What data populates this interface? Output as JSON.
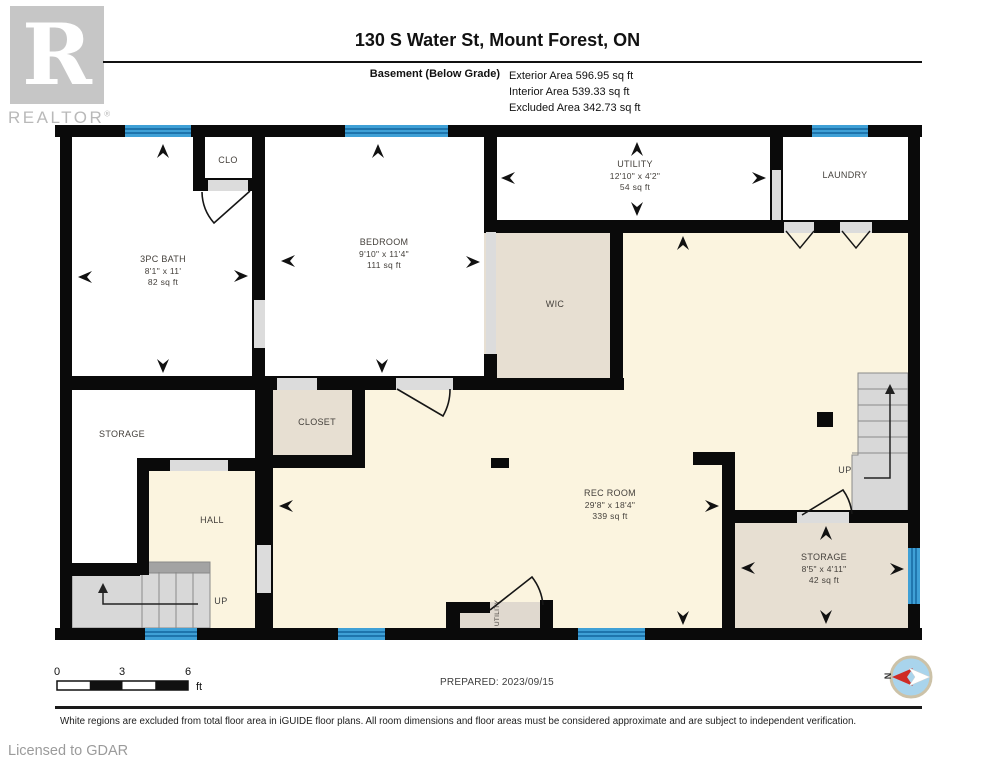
{
  "header": {
    "title": "130 S Water St, Mount Forest, ON",
    "floor_label": "Basement (Below Grade)",
    "areas": [
      "Exterior Area 596.95 sq ft",
      "Interior Area 539.33 sq ft",
      "Excluded Area 342.73 sq ft"
    ],
    "logo_letter": "R",
    "logo_text": "REALTOR",
    "registered_mark": "®"
  },
  "rooms": [
    {
      "name": "3PC BATH",
      "dims": "8'1\" x 11'",
      "area": "82 sq ft"
    },
    {
      "name": "CLO"
    },
    {
      "name": "BEDROOM",
      "dims": "9'10\" x 11'4\"",
      "area": "111 sq ft"
    },
    {
      "name": "UTILITY",
      "dims": "12'10\" x 4'2\"",
      "area": "54 sq ft"
    },
    {
      "name": "LAUNDRY"
    },
    {
      "name": "WIC"
    },
    {
      "name": "STORAGE"
    },
    {
      "name": "CLOSET"
    },
    {
      "name": "HALL"
    },
    {
      "name": "REC ROOM",
      "dims": "29'8\" x 18'4\"",
      "area": "339 sq ft"
    },
    {
      "name": "STORAGE",
      "dims": "8'5\" x 4'11\"",
      "area": "42 sq ft"
    },
    {
      "name": "UTILITY"
    }
  ],
  "stairs": {
    "up_left": "UP",
    "up_right": "UP"
  },
  "compass": {
    "north": "N"
  },
  "scale_bar": {
    "ticks": [
      "0",
      "3",
      "6"
    ],
    "unit": "ft"
  },
  "footer": {
    "prepared": "PREPARED: 2023/09/15",
    "disclaimer": "White regions are excluded from total floor area in iGUIDE floor plans. All room dimensions and floor areas must be considered approximate and are subject to independent verification.",
    "licensed": "Licensed to GDAR"
  },
  "colors": {
    "wall": "#0A0A0A",
    "included_area": "#FBF4DF",
    "secondary_area": "#E7DFD2",
    "window_blue": "#3FA0D6",
    "compass_red": "#CF2B24"
  }
}
